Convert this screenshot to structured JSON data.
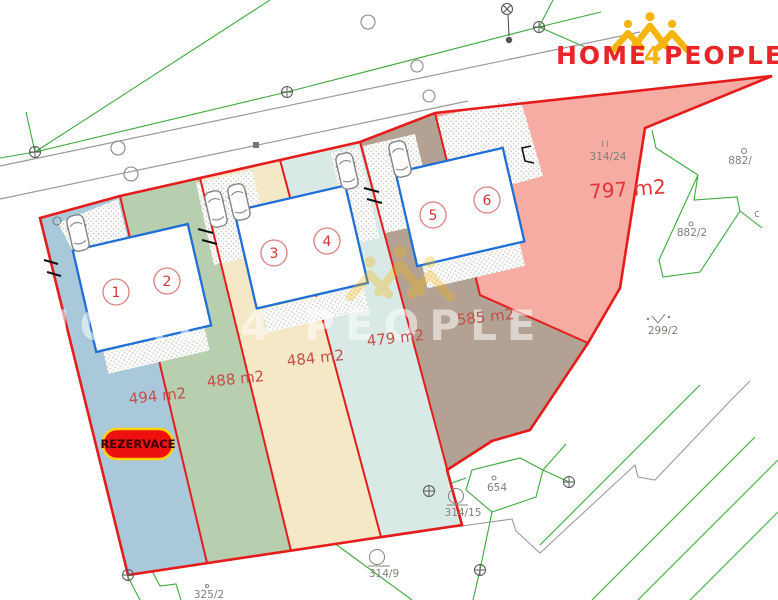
{
  "logo": {
    "home": "HOME",
    "four": "4",
    "people": "PEOPLE",
    "red": "#e8262a",
    "gold": "#f5b50d"
  },
  "watermark": {
    "text": "HOME 4 PEOPLE"
  },
  "badge": {
    "text": "REZERVACE",
    "fill": "#ee0f0f",
    "border": "#ffd400"
  },
  "parcels": [
    {
      "house": "1",
      "area": "494 m2",
      "color": "#a9c8da",
      "status": "reserved"
    },
    {
      "house": "2",
      "area": "488 m2",
      "color": "#b7cfae",
      "status": ""
    },
    {
      "house": "3",
      "area": "484 m2",
      "color": "#f5e8c6",
      "status": ""
    },
    {
      "house": "4",
      "area": "479 m2",
      "color": "#d9eae6",
      "status": ""
    },
    {
      "house": "5",
      "area": "585 m2",
      "color": "#b3a293",
      "status": ""
    },
    {
      "house": "6",
      "area": "797 m2",
      "color": "#f6aba3",
      "status": ""
    }
  ],
  "houses": [
    "1",
    "2",
    "3",
    "4",
    "5",
    "6"
  ],
  "cadastral": {
    "p314_24": "314/24",
    "roman": "II",
    "p882": "882/",
    "p882_2": "882/2",
    "p299_2": "299/2",
    "p654": "654",
    "p314_15": "314/15",
    "p314_9": "314/9",
    "p325_2": "325/2",
    "c": "c"
  },
  "colors": {
    "boundary_red": "#e51c1c",
    "house_outline_blue": "#1f6fd6",
    "cadastral_green": "#3caa3c",
    "road_gray": "#999999"
  }
}
